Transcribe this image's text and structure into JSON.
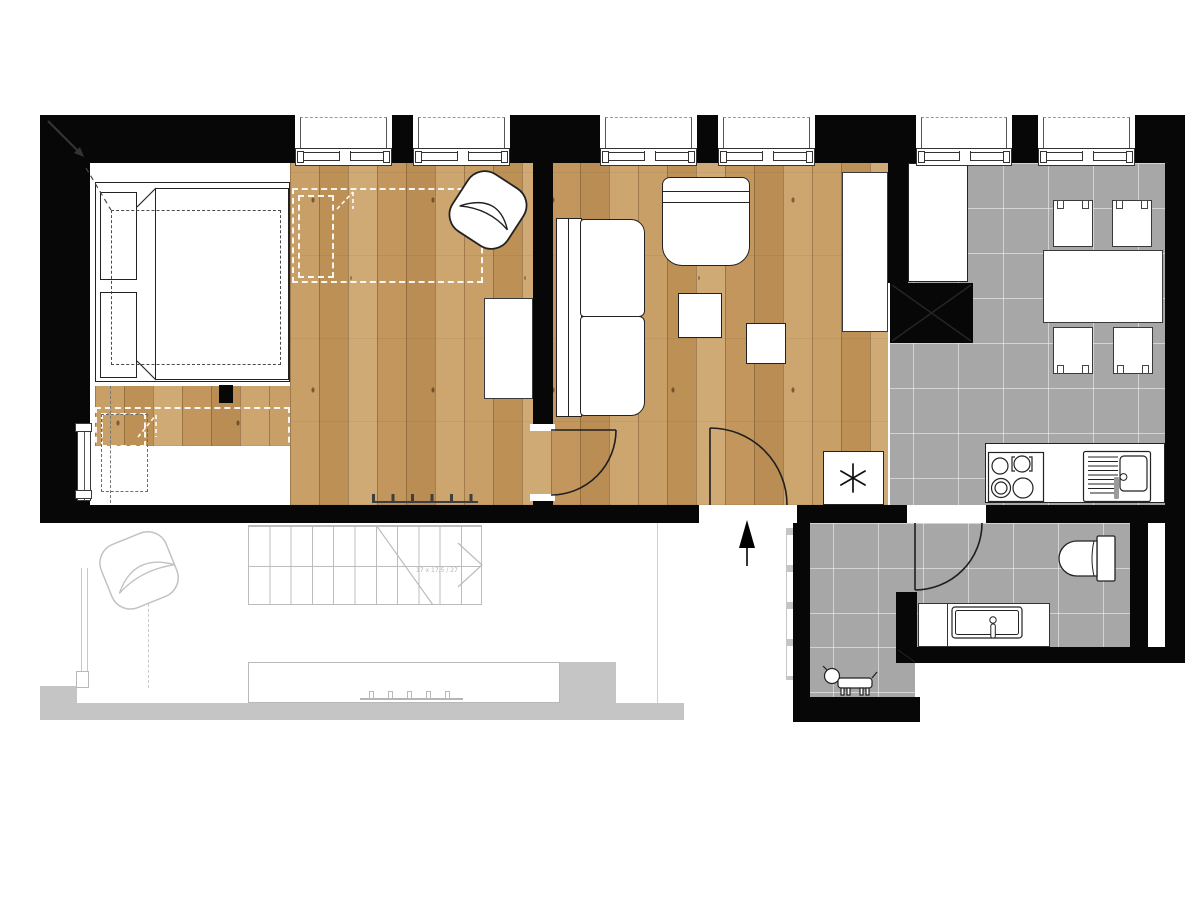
{
  "meta": {
    "title": "Apartment floor plan - upper level",
    "type": "architectural-floor-plan",
    "view": "top-down plan with lower level shown ghosted"
  },
  "legend": {
    "wall_color": "#070707",
    "wood_floor_color": "#c49a60",
    "tile_floor_color": "#a7a7a7",
    "lower_level_ghost_color": "#c5c5c5",
    "furniture_fill": "#ffffff"
  },
  "stairs": {
    "note": "17 x 17,5 / 27",
    "tread_count": 11,
    "direction": "arrow-right"
  },
  "windows": {
    "count": 6
  },
  "symbols": {
    "entry_arrow": "up-triangle",
    "utility_marker": "six-spoke asterisk",
    "corner_arrow": "diagonal arrow top-left",
    "pet_silhouette": "dog"
  },
  "rooms": [
    {
      "name": "sleeping-area",
      "floor": "white-and-wood"
    },
    {
      "name": "living-area",
      "floor": "wood"
    },
    {
      "name": "kitchen-dining",
      "floor": "gray-tile"
    },
    {
      "name": "hallway",
      "floor": "gray-tile"
    },
    {
      "name": "bathroom",
      "floor": "gray-tile"
    },
    {
      "name": "void-over-lower-level",
      "floor": "open"
    }
  ],
  "furniture": [
    "double-bed",
    "dashed-wardrobe-outlines",
    "rotated-lounge-chair",
    "sofa",
    "armchair",
    "coffee-table",
    "side-table",
    "desk",
    "side-cabinet",
    "tall-cabinet",
    "utility-box",
    "dining-table",
    "dining-chairs-x4",
    "cooktop",
    "kitchen-sink",
    "washbasin",
    "toilet",
    "ghost-lounge-chair",
    "ghost-kitchen-island",
    "ghost-bar-stools",
    "ghost-staircase",
    "dog"
  ]
}
